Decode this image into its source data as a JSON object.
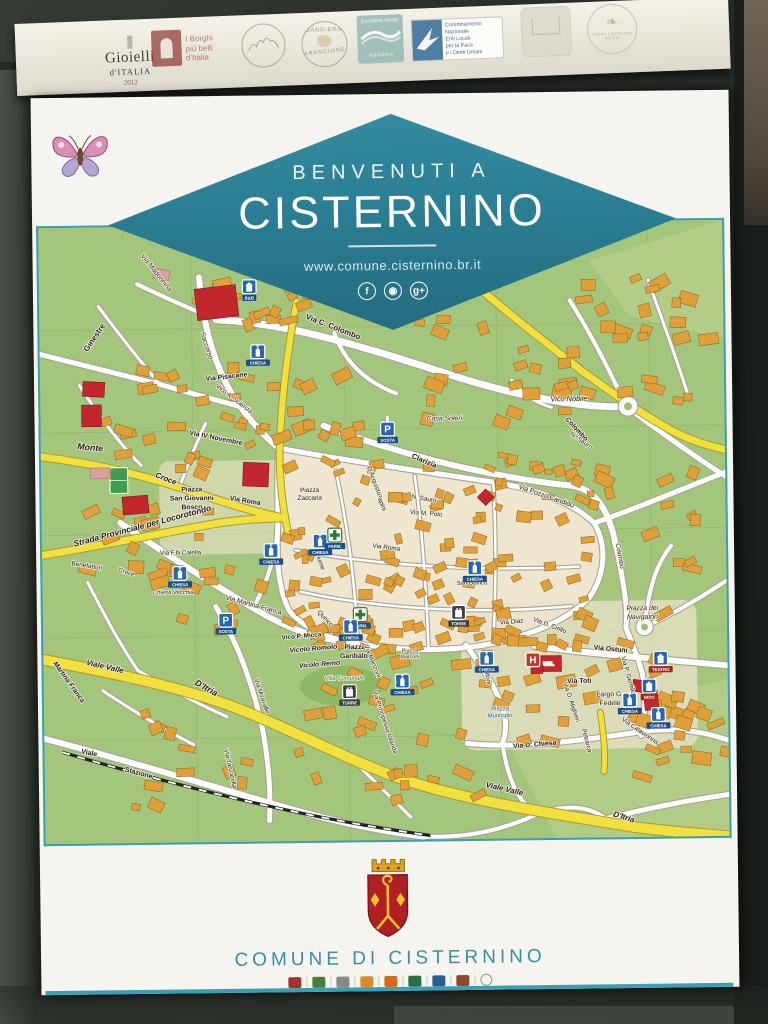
{
  "top_strip": {
    "gioielli": [
      "Gioielli",
      "d'ITALIA",
      "2012"
    ],
    "borghi": [
      "I Borghi",
      "più belli",
      "d'Italia"
    ],
    "arancione": [
      "BANDIERA",
      "ARANCIONE"
    ],
    "verde": [
      "Bandiera Verde",
      "Agricoltura"
    ],
    "pace_lines": [
      "Coordinamento",
      "Nazionale",
      "Enti Locali",
      "per la Pace",
      "e i Diritti Umani"
    ],
    "terra": "TERRA LIBERA DAI VELENI"
  },
  "banner": {
    "welcome": "BENVENUTI A",
    "town": "CISTERNINO",
    "url": "www.comune.cisternino.br.it",
    "social": [
      {
        "name": "facebook",
        "glyph": "f"
      },
      {
        "name": "instagram",
        "glyph": "◉"
      },
      {
        "name": "google-plus",
        "glyph": "g+"
      }
    ]
  },
  "footer": {
    "municipality": "COMUNE DI CISTERNINO"
  },
  "map": {
    "street_labels": [
      {
        "t": "Ginestre",
        "x": 58,
        "y": 113,
        "r": -55,
        "s": 8,
        "b": 1
      },
      {
        "t": "Via Madonnina",
        "x": 118,
        "y": 48,
        "r": 52,
        "s": 7
      },
      {
        "t": "Via C. Colombo",
        "x": 298,
        "y": 106,
        "r": 22,
        "s": 8,
        "b": 1
      },
      {
        "t": "Soccorso",
        "x": 168,
        "y": 122,
        "r": 72,
        "s": 7
      },
      {
        "t": "Via Pisacane",
        "x": 190,
        "y": 155,
        "r": -6,
        "s": 7,
        "b": 1
      },
      {
        "t": "Vico A. Scienza",
        "x": 196,
        "y": 177,
        "r": 38,
        "s": 6.5
      },
      {
        "t": "Via IV Novembre",
        "x": 178,
        "y": 217,
        "r": 12,
        "s": 7,
        "b": 1
      },
      {
        "t": "Monte",
        "x": 50,
        "y": 226,
        "r": 6,
        "s": 9,
        "b": 1,
        "i": 1
      },
      {
        "t": "Croce",
        "x": 126,
        "y": 258,
        "r": 22,
        "s": 8,
        "b": 1,
        "i": 1
      },
      {
        "t": "Piazza",
        "x": 153,
        "y": 269,
        "s": 7,
        "b": 1
      },
      {
        "t": "San Giovanni",
        "x": 153,
        "y": 278,
        "s": 7,
        "b": 1
      },
      {
        "t": "Bosco",
        "x": 153,
        "y": 287,
        "s": 7,
        "b": 1
      },
      {
        "t": "Via Roma",
        "x": 207,
        "y": 281,
        "r": 10,
        "s": 7,
        "b": 1
      },
      {
        "t": "Strada Provinciale per Locorotondo",
        "x": 103,
        "y": 306,
        "r": -14,
        "s": 8.5,
        "b": 1,
        "i": 1
      },
      {
        "t": "Via F.lli Calella",
        "x": 141,
        "y": 333,
        "s": 6.5
      },
      {
        "t": "Benefattori",
        "x": 45,
        "y": 345,
        "r": 10,
        "s": 6.5
      },
      {
        "t": "Croce",
        "x": 85,
        "y": 352,
        "r": 18,
        "s": 6.5
      },
      {
        "t": "Chiesa Vecchia",
        "x": 133,
        "y": 373,
        "s": 6,
        "i": 1
      },
      {
        "t": "Via Martina Franca",
        "x": 214,
        "y": 387,
        "r": 16,
        "s": 7
      },
      {
        "t": "Quirico",
        "x": 286,
        "y": 401,
        "r": 48,
        "s": 6.5
      },
      {
        "t": "Vico P. Micca",
        "x": 263,
        "y": 419,
        "r": -4,
        "s": 6.5,
        "b": 1
      },
      {
        "t": "Vicolo Romolo",
        "x": 275,
        "y": 432,
        "r": -4,
        "s": 7,
        "b": 1,
        "i": 1
      },
      {
        "t": "Vicolo Remo",
        "x": 281,
        "y": 448,
        "r": -4,
        "s": 7,
        "b": 1,
        "i": 1
      },
      {
        "t": "Piazza",
        "x": 317,
        "y": 431,
        "s": 7,
        "b": 1
      },
      {
        "t": "Garibaldi",
        "x": 317,
        "y": 440,
        "s": 7,
        "b": 1
      },
      {
        "t": "Villa Comunale",
        "x": 306,
        "y": 462,
        "s": 6,
        "i": 1,
        "c": "#2b6f46"
      },
      {
        "t": "Via Manzoni",
        "x": 333,
        "y": 444,
        "r": 68,
        "s": 6.5
      },
      {
        "t": "Via Miravalle",
        "x": 220,
        "y": 478,
        "r": 72,
        "s": 6.5
      },
      {
        "t": "Viale Valle",
        "x": 62,
        "y": 448,
        "r": 14,
        "s": 8,
        "b": 1,
        "i": 1
      },
      {
        "t": "D'Itria",
        "x": 164,
        "y": 471,
        "r": 30,
        "s": 9,
        "b": 1,
        "i": 1
      },
      {
        "t": "Martina Franca",
        "x": 24,
        "y": 462,
        "r": 55,
        "s": 7,
        "b": 1,
        "i": 1
      },
      {
        "t": "Via Principessa Iolanda",
        "x": 345,
        "y": 506,
        "r": 72,
        "s": 6.5
      },
      {
        "t": "Viale",
        "x": 45,
        "y": 535,
        "r": 12,
        "s": 7,
        "b": 1
      },
      {
        "t": "Stazione",
        "x": 95,
        "y": 556,
        "r": 16,
        "s": 7,
        "b": 1
      },
      {
        "t": "Via Tanzarella",
        "x": 187,
        "y": 551,
        "r": 78,
        "s": 6.5
      },
      {
        "t": "Viale Valle",
        "x": 467,
        "y": 577,
        "r": 14,
        "s": 8,
        "b": 1,
        "i": 1
      },
      {
        "t": "D'Itria",
        "x": 588,
        "y": 607,
        "r": 18,
        "s": 8,
        "b": 1,
        "i": 1
      },
      {
        "t": "Casa Soleri",
        "x": 411,
        "y": 200,
        "s": 7,
        "i": 1
      },
      {
        "t": "Clarizia",
        "x": 389,
        "y": 243,
        "r": 24,
        "s": 7.5,
        "b": 1
      },
      {
        "t": "Piazza",
        "x": 273,
        "y": 271,
        "s": 6.5
      },
      {
        "t": "Zaccaria",
        "x": 273,
        "y": 279,
        "s": 6.5
      },
      {
        "t": "N. Sauro",
        "x": 389,
        "y": 281,
        "r": 10,
        "s": 6.5
      },
      {
        "t": "Via M. Polo",
        "x": 391,
        "y": 296,
        "r": 6,
        "s": 6.5
      },
      {
        "t": "Papini",
        "x": 344,
        "y": 283,
        "r": 70,
        "s": 6.5
      },
      {
        "t": "D'Acquisto",
        "x": 337,
        "y": 261,
        "r": 70,
        "s": 6.5
      },
      {
        "t": "Via Roma",
        "x": 350,
        "y": 330,
        "r": 8,
        "s": 6.5
      },
      {
        "t": "San Quirico",
        "x": 437,
        "y": 367,
        "s": 6,
        "i": 1
      },
      {
        "t": "Fiume",
        "x": 281,
        "y": 342,
        "r": 72,
        "s": 6.5
      },
      {
        "t": "Vico Nobile",
        "x": 538,
        "y": 182,
        "s": 7.5,
        "i": 1
      },
      {
        "t": "Colombo",
        "x": 544,
        "y": 212,
        "r": 48,
        "s": 7,
        "b": 1
      },
      {
        "t": "N. Sauro",
        "x": 549,
        "y": 224,
        "r": 35,
        "s": 6.5
      },
      {
        "t": "Via Pozzo Candido",
        "x": 513,
        "y": 280,
        "r": 20,
        "s": 7
      },
      {
        "t": "Colombo",
        "x": 586,
        "y": 340,
        "r": 80,
        "s": 6.5
      },
      {
        "t": "Via Ostuni",
        "x": 577,
        "y": 436,
        "r": 6,
        "s": 7,
        "b": 1
      },
      {
        "t": "Via Toti",
        "x": 545,
        "y": 468,
        "s": 7,
        "b": 1
      },
      {
        "t": "Largo G.",
        "x": 576,
        "y": 482,
        "s": 7
      },
      {
        "t": "Fedele",
        "x": 576,
        "y": 491,
        "s": 7
      },
      {
        "t": "Via Diaz",
        "x": 477,
        "y": 407,
        "r": -4,
        "s": 6.5
      },
      {
        "t": "Via D. Cirillo",
        "x": 515,
        "y": 411,
        "r": 22,
        "s": 6.5
      },
      {
        "t": "Piazza",
        "x": 464,
        "y": 495,
        "s": 6,
        "c": "#1f4f8f"
      },
      {
        "t": "Municipio",
        "x": 464,
        "y": 502,
        "s": 6,
        "c": "#1f4f8f"
      },
      {
        "t": "Via D. Chiesa",
        "x": 499,
        "y": 532,
        "r": -4,
        "s": 7,
        "b": 1
      },
      {
        "t": "Petrarca",
        "x": 550,
        "y": 527,
        "r": 75,
        "s": 6.5
      },
      {
        "t": "Via Calavionna",
        "x": 605,
        "y": 519,
        "r": 35,
        "s": 6.5
      },
      {
        "t": "Piazza dei",
        "x": 610,
        "y": 395,
        "s": 7,
        "i": 1
      },
      {
        "t": "Navigatori",
        "x": 610,
        "y": 404,
        "s": 7,
        "i": 1
      },
      {
        "t": "Via P. Gentile",
        "x": 593,
        "y": 461,
        "r": 75,
        "s": 6.5
      },
      {
        "t": "Via D. Alighieri",
        "x": 535,
        "y": 488,
        "r": 72,
        "s": 6.5
      },
      {
        "t": "Caprifoni",
        "x": 449,
        "y": 456,
        "r": 80,
        "s": 6.5
      },
      {
        "t": "Piazza",
        "x": 373,
        "y": 435,
        "s": 5.5
      },
      {
        "t": "Marconi",
        "x": 373,
        "y": 441,
        "s": 5.5
      },
      {
        "t": "USL",
        "x": 514,
        "y": 450,
        "s": 5.5,
        "b": 1,
        "c": "#ffffff"
      }
    ],
    "markers": [
      {
        "k": "building",
        "x": 214,
        "y": 62,
        "l": "B&B"
      },
      {
        "k": "church",
        "x": 222,
        "y": 128,
        "l": "CHIESA"
      },
      {
        "k": "church",
        "x": 233,
        "y": 330,
        "l": "CHIESA"
      },
      {
        "k": "church",
        "x": 140,
        "y": 352,
        "l": "CHIESA"
      },
      {
        "k": "church",
        "x": 283,
        "y": 321,
        "l": "CHIESA"
      },
      {
        "k": "parking",
        "x": 353,
        "y": 208,
        "l": "SOSTA"
      },
      {
        "k": "parking",
        "x": 186,
        "y": 400,
        "l": "SOSTA"
      },
      {
        "k": "pharmacy",
        "x": 298,
        "y": 315,
        "l": "FARM."
      },
      {
        "k": "pharmacy",
        "x": 323,
        "y": 396,
        "l": "FARM."
      },
      {
        "k": "church",
        "x": 313,
        "y": 408,
        "l": "CHIESA"
      },
      {
        "k": "church",
        "x": 440,
        "y": 350,
        "l": "CHIESA"
      },
      {
        "k": "castle",
        "x": 423,
        "y": 395,
        "l": "TORRE"
      },
      {
        "k": "castle",
        "x": 311,
        "y": 474,
        "l": "TORRE"
      },
      {
        "k": "church",
        "x": 365,
        "y": 464,
        "l": "CHIESA"
      },
      {
        "k": "church",
        "x": 451,
        "y": 442,
        "l": "CHIESA"
      },
      {
        "k": "hospital",
        "x": 498,
        "y": 444,
        "l": ""
      },
      {
        "k": "church",
        "x": 596,
        "y": 486,
        "l": "CHIESA"
      },
      {
        "k": "building",
        "x": 628,
        "y": 444,
        "l": "TEATRO"
      },
      {
        "k": "building",
        "x": 616,
        "y": 472,
        "l": "NIDO"
      },
      {
        "k": "church",
        "x": 625,
        "y": 501,
        "l": "CHIESA"
      }
    ]
  }
}
